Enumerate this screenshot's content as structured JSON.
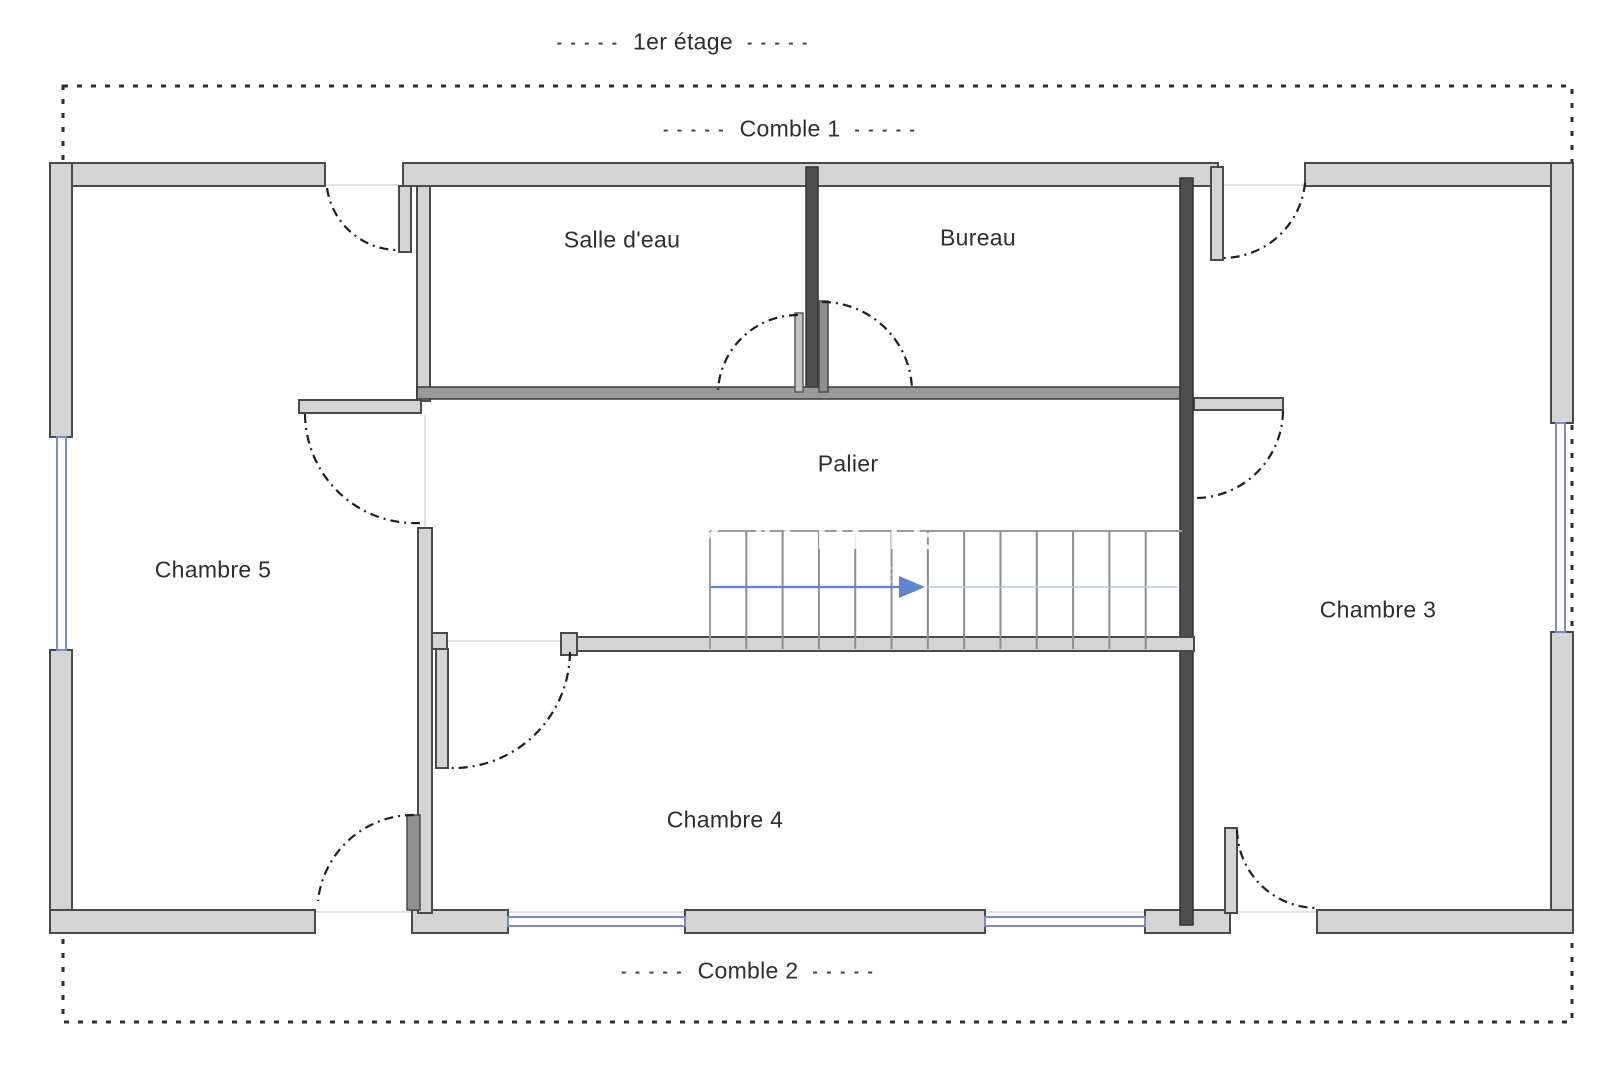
{
  "plan": {
    "dash": "- - - - -",
    "title": "1er étage"
  },
  "attics": [
    {
      "id": "comble-1",
      "name": "Comble 1"
    },
    {
      "id": "comble-2",
      "name": "Comble 2"
    }
  ],
  "rooms": [
    {
      "id": "salle-d-eau",
      "name": "Salle d'eau"
    },
    {
      "id": "bureau",
      "name": "Bureau"
    },
    {
      "id": "palier",
      "name": "Palier"
    },
    {
      "id": "chambre-5",
      "name": "Chambre 5"
    },
    {
      "id": "chambre-3",
      "name": "Chambre 3"
    },
    {
      "id": "chambre-4",
      "name": "Chambre 4"
    }
  ],
  "stairs": {
    "tread_count": 13,
    "arrow_direction": "right"
  },
  "watermark": {
    "line1": "K ACHETE",
    "line2": "N E R"
  },
  "colors": {
    "wall_fill": "#d4d4d4",
    "wall_edge": "#4a4a4a",
    "wall_dark": "#4e4e4e",
    "window_blue": "#8287c6",
    "stair_line": "#8d8d8d",
    "arrow_blue": "#5d86cf",
    "arrow_light": "#b6c6e6",
    "label_text": "#2e2e2e",
    "boundary": "#2e2e2e",
    "faint_line": "#d9d9d9"
  }
}
